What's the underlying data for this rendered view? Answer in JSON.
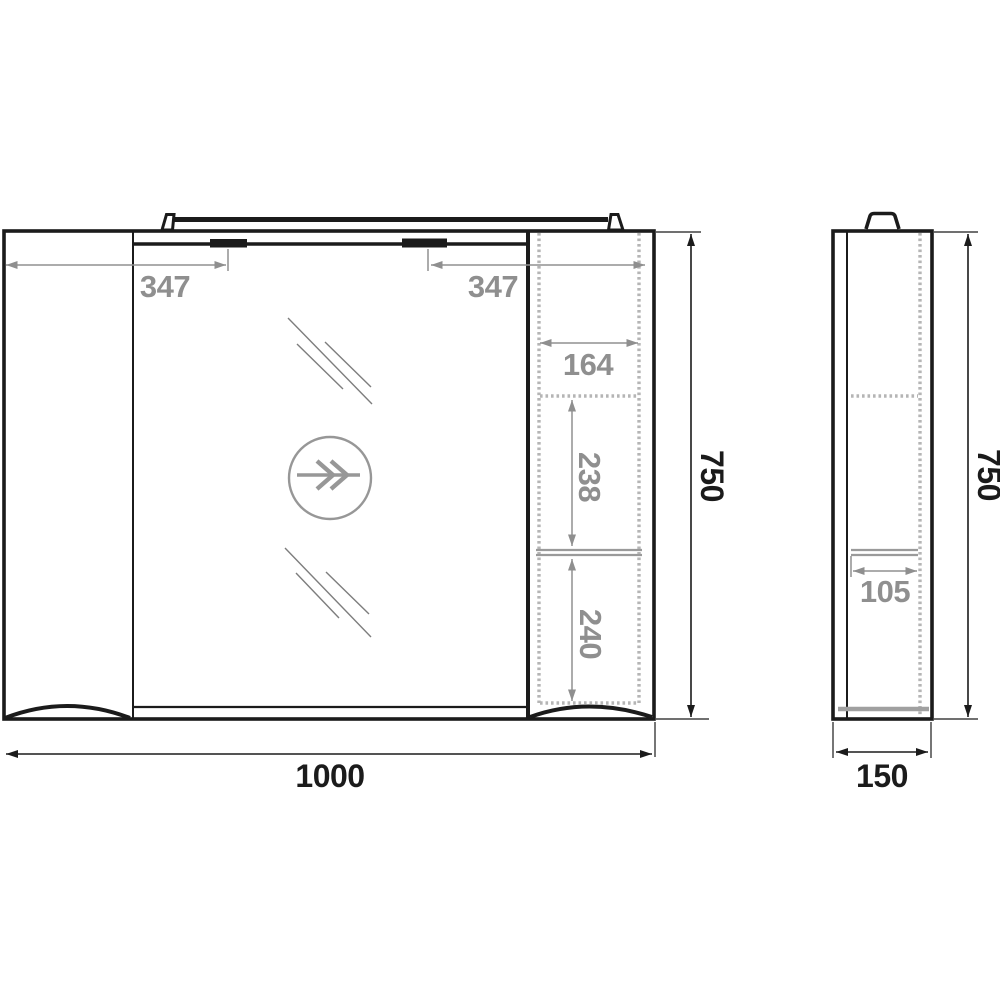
{
  "drawing": {
    "title": "mirror-cabinet-technical-drawing",
    "front_view": {
      "dimensions": {
        "left_light_offset": "347",
        "right_light_offset": "347",
        "shelf_width": "164",
        "middle_shelf_height": "238",
        "bottom_shelf_height": "240",
        "overall_height": "750",
        "overall_width": "1000"
      }
    },
    "side_view": {
      "dimensions": {
        "inner_shelf_depth": "105",
        "overall_height": "750",
        "overall_depth": "150"
      }
    },
    "colors": {
      "outline": "#1b1b1b",
      "dimension_gray": "#8f8f8f",
      "hatch_gray": "#b5b5b5",
      "background": "#ffffff"
    }
  }
}
